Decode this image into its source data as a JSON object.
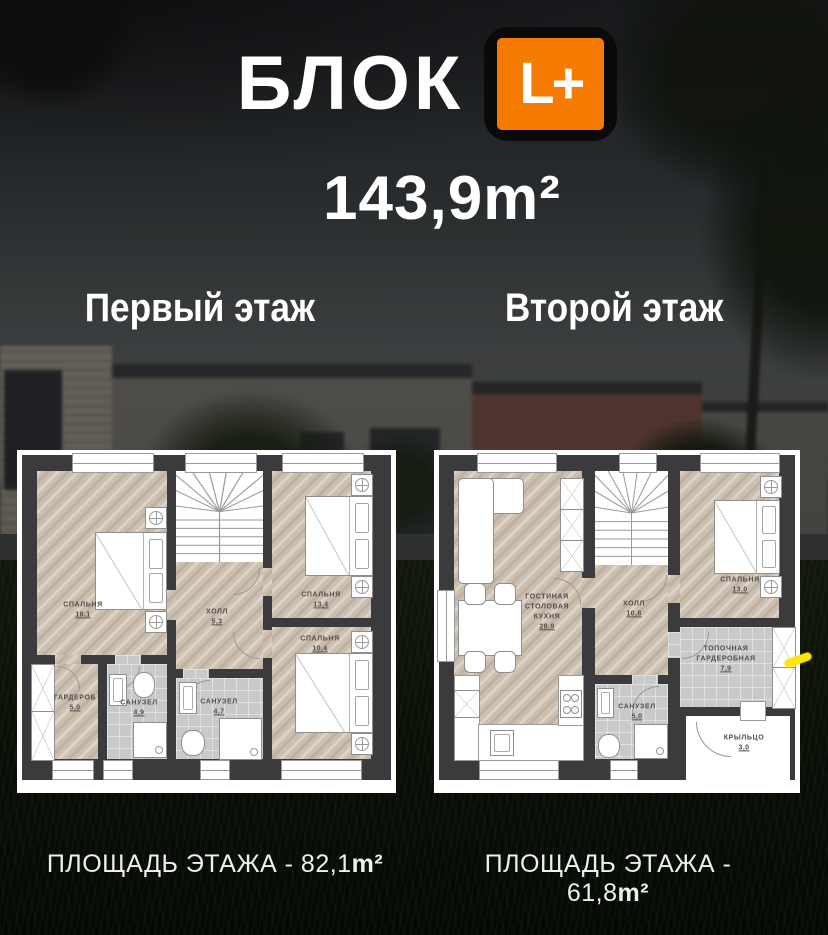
{
  "header": {
    "title": "БЛОК",
    "badge": "L+",
    "total_area": "143,9m²"
  },
  "colors": {
    "brand_orange": "#f57c00",
    "marker_yellow": "#ffe60a",
    "wall": "#3b3b3d"
  },
  "floors": {
    "first": {
      "title": "Первый этаж",
      "caption_prefix": "ПЛОЩАДЬ ЭТАЖА - 82,1",
      "caption_unit": "m²",
      "rooms": {
        "bedroom_181": {
          "name": "СПАЛЬНЯ",
          "area": "18,1"
        },
        "hall": {
          "name": "ХОЛЛ",
          "area": "5,3"
        },
        "bedroom_134": {
          "name": "СПАЛЬНЯ",
          "area": "13,4"
        },
        "bedroom_104": {
          "name": "СПАЛЬНЯ",
          "area": "10,4"
        },
        "wardrobe": {
          "name": "ГАРДЕРОБ",
          "area": "5,0"
        },
        "bath_49": {
          "name": "САНУЗЕЛ",
          "area": "4,9"
        },
        "bath_47": {
          "name": "САНУЗЕЛ",
          "area": "4,7"
        }
      }
    },
    "second": {
      "title": "Второй этаж",
      "caption_prefix": "ПЛОЩАДЬ ЭТАЖА - 61,8",
      "caption_unit": "m²",
      "rooms": {
        "living": {
          "name1": "ГОСТИНАЯ",
          "name2": "СТОЛОВАЯ",
          "name3": "КУХНЯ",
          "area": "28,9"
        },
        "hall": {
          "name": "ХОЛЛ",
          "area": "10,8"
        },
        "bedroom_130": {
          "name": "СПАЛЬНЯ",
          "area": "13,0"
        },
        "boiler": {
          "name1": "ТОПОЧНАЯ",
          "name2": "ГАРДЕРОБНАЯ",
          "area": "7,9"
        },
        "bath_50": {
          "name": "САНУЗЕЛ",
          "area": "5,0"
        },
        "porch": {
          "name": "КРЫЛЬЦО",
          "area": "3,0"
        }
      }
    }
  }
}
